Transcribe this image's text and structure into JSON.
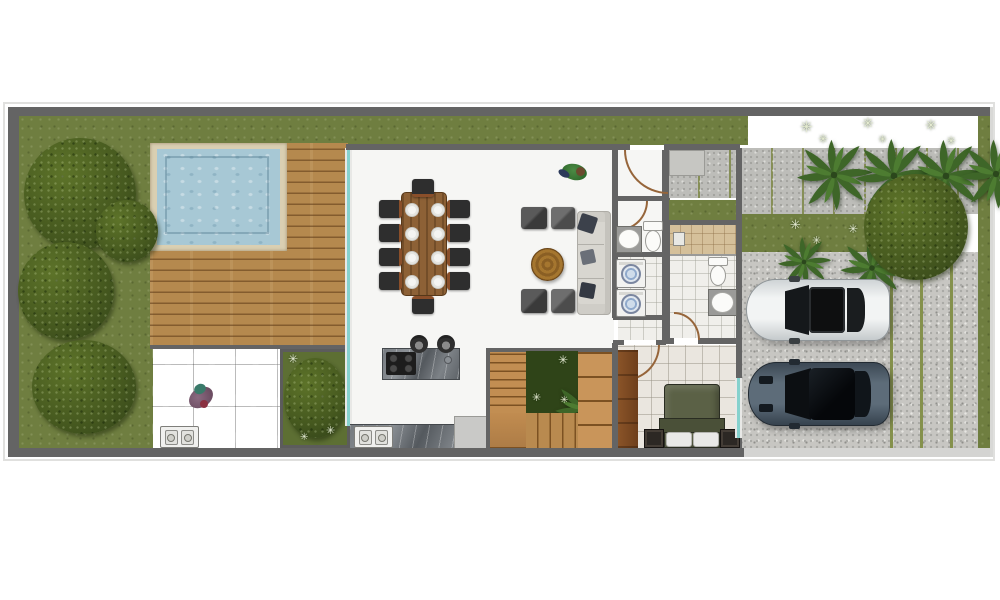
{
  "document": {
    "type": "architectural-floor-plan",
    "view": "top-down-render",
    "label": "Villa ground floor plan with pool, deck, garden and driveway"
  },
  "palette": {
    "grass": "#6f7e40",
    "grassDark": "#5d6f33",
    "bush": "#46591f",
    "bushHi": "#5d7329",
    "palm": "#3e6628",
    "palmHi": "#4d7c31",
    "wplant": "#e6ecd2",
    "wall": "#646464",
    "frame": "#e0e0de",
    "curb": "#d4d4d2",
    "poolWater": "#a7c8d5",
    "poolCoping": "#dacfb2",
    "deck": "#b5894e",
    "deckLine": "#7a5224",
    "floor": "#f6f6f4",
    "tile": "#eae6df",
    "tileBath": "#f0efeb",
    "showerTan": "#d5c09a",
    "patio": "#b3b3b1",
    "gravel": "#c7c6c2",
    "slab": "#bdbdb9",
    "joint": "#85914c",
    "glass": "#85d1cd",
    "marble": "#6a6f74",
    "woodTable": "#8d6136",
    "woodStairs": "#c28e52",
    "chair": "#2e2e2e",
    "sofa": "#d8d6d0",
    "pouf": "#404040",
    "pillow": "#3c414b",
    "bedOlive": "#5b6146",
    "bedFold": "#4a5038",
    "doorArc": "#96653a",
    "carWhite": "#e7e9e9",
    "carDark": "#52626f",
    "machineBlue": "#8fa9cc"
  },
  "white_plant_glyph": "✳",
  "rooms": [
    {
      "name": "left-garden",
      "features": [
        "lawn",
        "large shrubs"
      ]
    },
    {
      "name": "swimming-pool",
      "features": [
        "water",
        "stone coping"
      ]
    },
    {
      "name": "wood-deck",
      "features": [
        "horizontal plank decking"
      ]
    },
    {
      "name": "patio",
      "features": [
        "stone tiles",
        "person",
        "ac outdoor unit"
      ]
    },
    {
      "name": "planting-bed",
      "features": [
        "large shrub",
        "white accents"
      ]
    },
    {
      "name": "living-dining-room",
      "furniture": [
        "wood dining table",
        "10 dining chairs",
        "8 place settings",
        "4 lounge poufs",
        "round wood coffee table",
        "3-seat sofa with dark cushions"
      ]
    },
    {
      "name": "kitchen",
      "furniture": [
        "marble island with 4-burner gas hob",
        "2 bar stools",
        "marble counter",
        "double sink",
        "appliance"
      ]
    },
    {
      "name": "staircase",
      "features": [
        "wood treads",
        "central planter with tropical plant"
      ]
    },
    {
      "name": "entry-vestibule",
      "features": [
        "entry door with swing arc"
      ]
    },
    {
      "name": "entry-porch",
      "features": [
        "concrete slabs",
        "grass strip"
      ]
    },
    {
      "name": "powder-room",
      "furniture": [
        "washbasin",
        "toilet"
      ]
    },
    {
      "name": "laundry",
      "furniture": [
        "2 stacked washing machines"
      ]
    },
    {
      "name": "hallway",
      "features": [
        "tile floor",
        "door arcs"
      ]
    },
    {
      "name": "shower-room",
      "furniture": [
        "walk-in shower, tan tile"
      ]
    },
    {
      "name": "bathroom",
      "furniture": [
        "toilet",
        "washbasin"
      ]
    },
    {
      "name": "bedroom",
      "furniture": [
        "double bed with olive duvet",
        "2 white pillows",
        "2 dark nightstands",
        "wood wardrobe",
        "window"
      ]
    },
    {
      "name": "walkway",
      "features": [
        "paving slabs",
        "4 palm trees",
        "white ornamental plants",
        "round tree"
      ]
    },
    {
      "name": "mid-grass-strip",
      "features": [
        "2 palm trees",
        "white ornamental plants"
      ]
    },
    {
      "name": "driveway",
      "features": [
        "gravel with grass joint lines",
        "2 parked cars"
      ]
    }
  ],
  "counts": {
    "dining_chairs": 10,
    "place_settings": 8,
    "lounge_poufs": 4,
    "sofas": 1,
    "coffee_tables": 1,
    "bar_stools": 2,
    "washing_machines": 2,
    "toilets": 2,
    "washbasins": 2,
    "kitchen_sinks": 1,
    "showers": 1,
    "beds": 1,
    "nightstands": 2,
    "wardrobes": 1,
    "cars": 2,
    "palm_trees": 6,
    "garden_shrubs": 5,
    "people": 2,
    "ac_units": 1,
    "pools": 1
  },
  "vehicles": [
    {
      "type": "car",
      "color": "white",
      "position": "upper parking spot",
      "facing": "left"
    },
    {
      "type": "car",
      "color": "dark blue-gray",
      "position": "lower parking spot",
      "facing": "left"
    }
  ],
  "people": [
    {
      "location": "living-room near entry",
      "clothing": "green top"
    },
    {
      "location": "patio",
      "clothing": "purple"
    }
  ]
}
